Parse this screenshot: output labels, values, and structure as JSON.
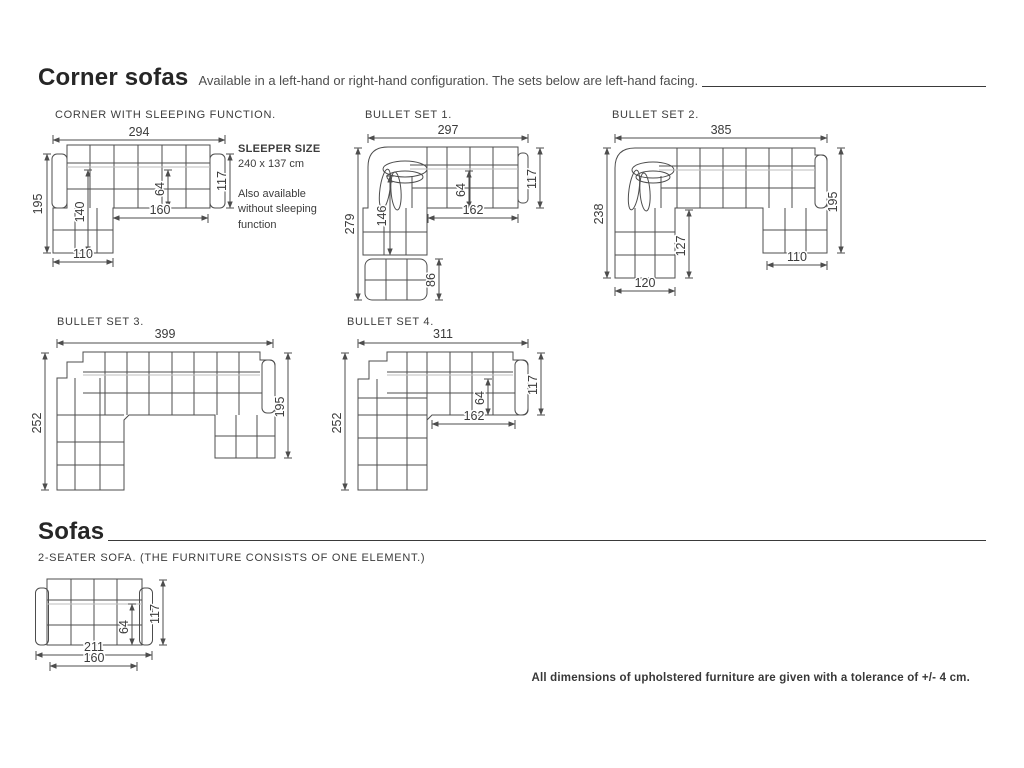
{
  "header": {
    "title": "Corner sofas",
    "subtitle": "Available in a left-hand or right-hand configuration. The sets below are left-hand facing."
  },
  "sofas_header": {
    "title": "Sofas"
  },
  "diagrams": {
    "corner_sleeping": {
      "label": "CORNER WITH SLEEPING FUNCTION.",
      "dims": {
        "total_width": "294",
        "total_depth": "195",
        "inner_depth": "140",
        "seat_depth": "64",
        "seat_width": "160",
        "body_depth": "117",
        "chaise_width": "110"
      },
      "note": {
        "title": "SLEEPER SIZE",
        "size": "240 x 137 cm",
        "extra": "Also available without sleeping function"
      }
    },
    "bullet_set_1": {
      "label": "BULLET SET 1.",
      "dims": {
        "total_width": "297",
        "total_depth": "279",
        "inner_depth": "146",
        "seat_depth": "64",
        "seat_width": "162",
        "body_depth": "117",
        "ottoman_depth": "86"
      }
    },
    "bullet_set_2": {
      "label": "BULLET SET 2.",
      "dims": {
        "total_width": "385",
        "left_depth": "238",
        "inner_depth": "127",
        "left_chaise_width": "120",
        "right_depth": "195",
        "right_chaise_width": "110"
      }
    },
    "bullet_set_3": {
      "label": "BULLET SET 3.",
      "dims": {
        "total_width": "399",
        "left_depth": "252",
        "right_depth": "195"
      }
    },
    "bullet_set_4": {
      "label": "BULLET SET 4.",
      "dims": {
        "total_width": "311",
        "left_depth": "252",
        "seat_depth": "64",
        "seat_width": "162",
        "body_depth": "117"
      }
    },
    "two_seater": {
      "label": "2-SEATER SOFA. (THE FURNITURE CONSISTS OF ONE ELEMENT.)",
      "dims": {
        "total_width": "211",
        "seat_width": "160",
        "seat_depth": "64",
        "body_depth": "117"
      }
    }
  },
  "footer": {
    "note": "All dimensions of upholstered furniture are given with a tolerance of +/- 4 cm."
  }
}
